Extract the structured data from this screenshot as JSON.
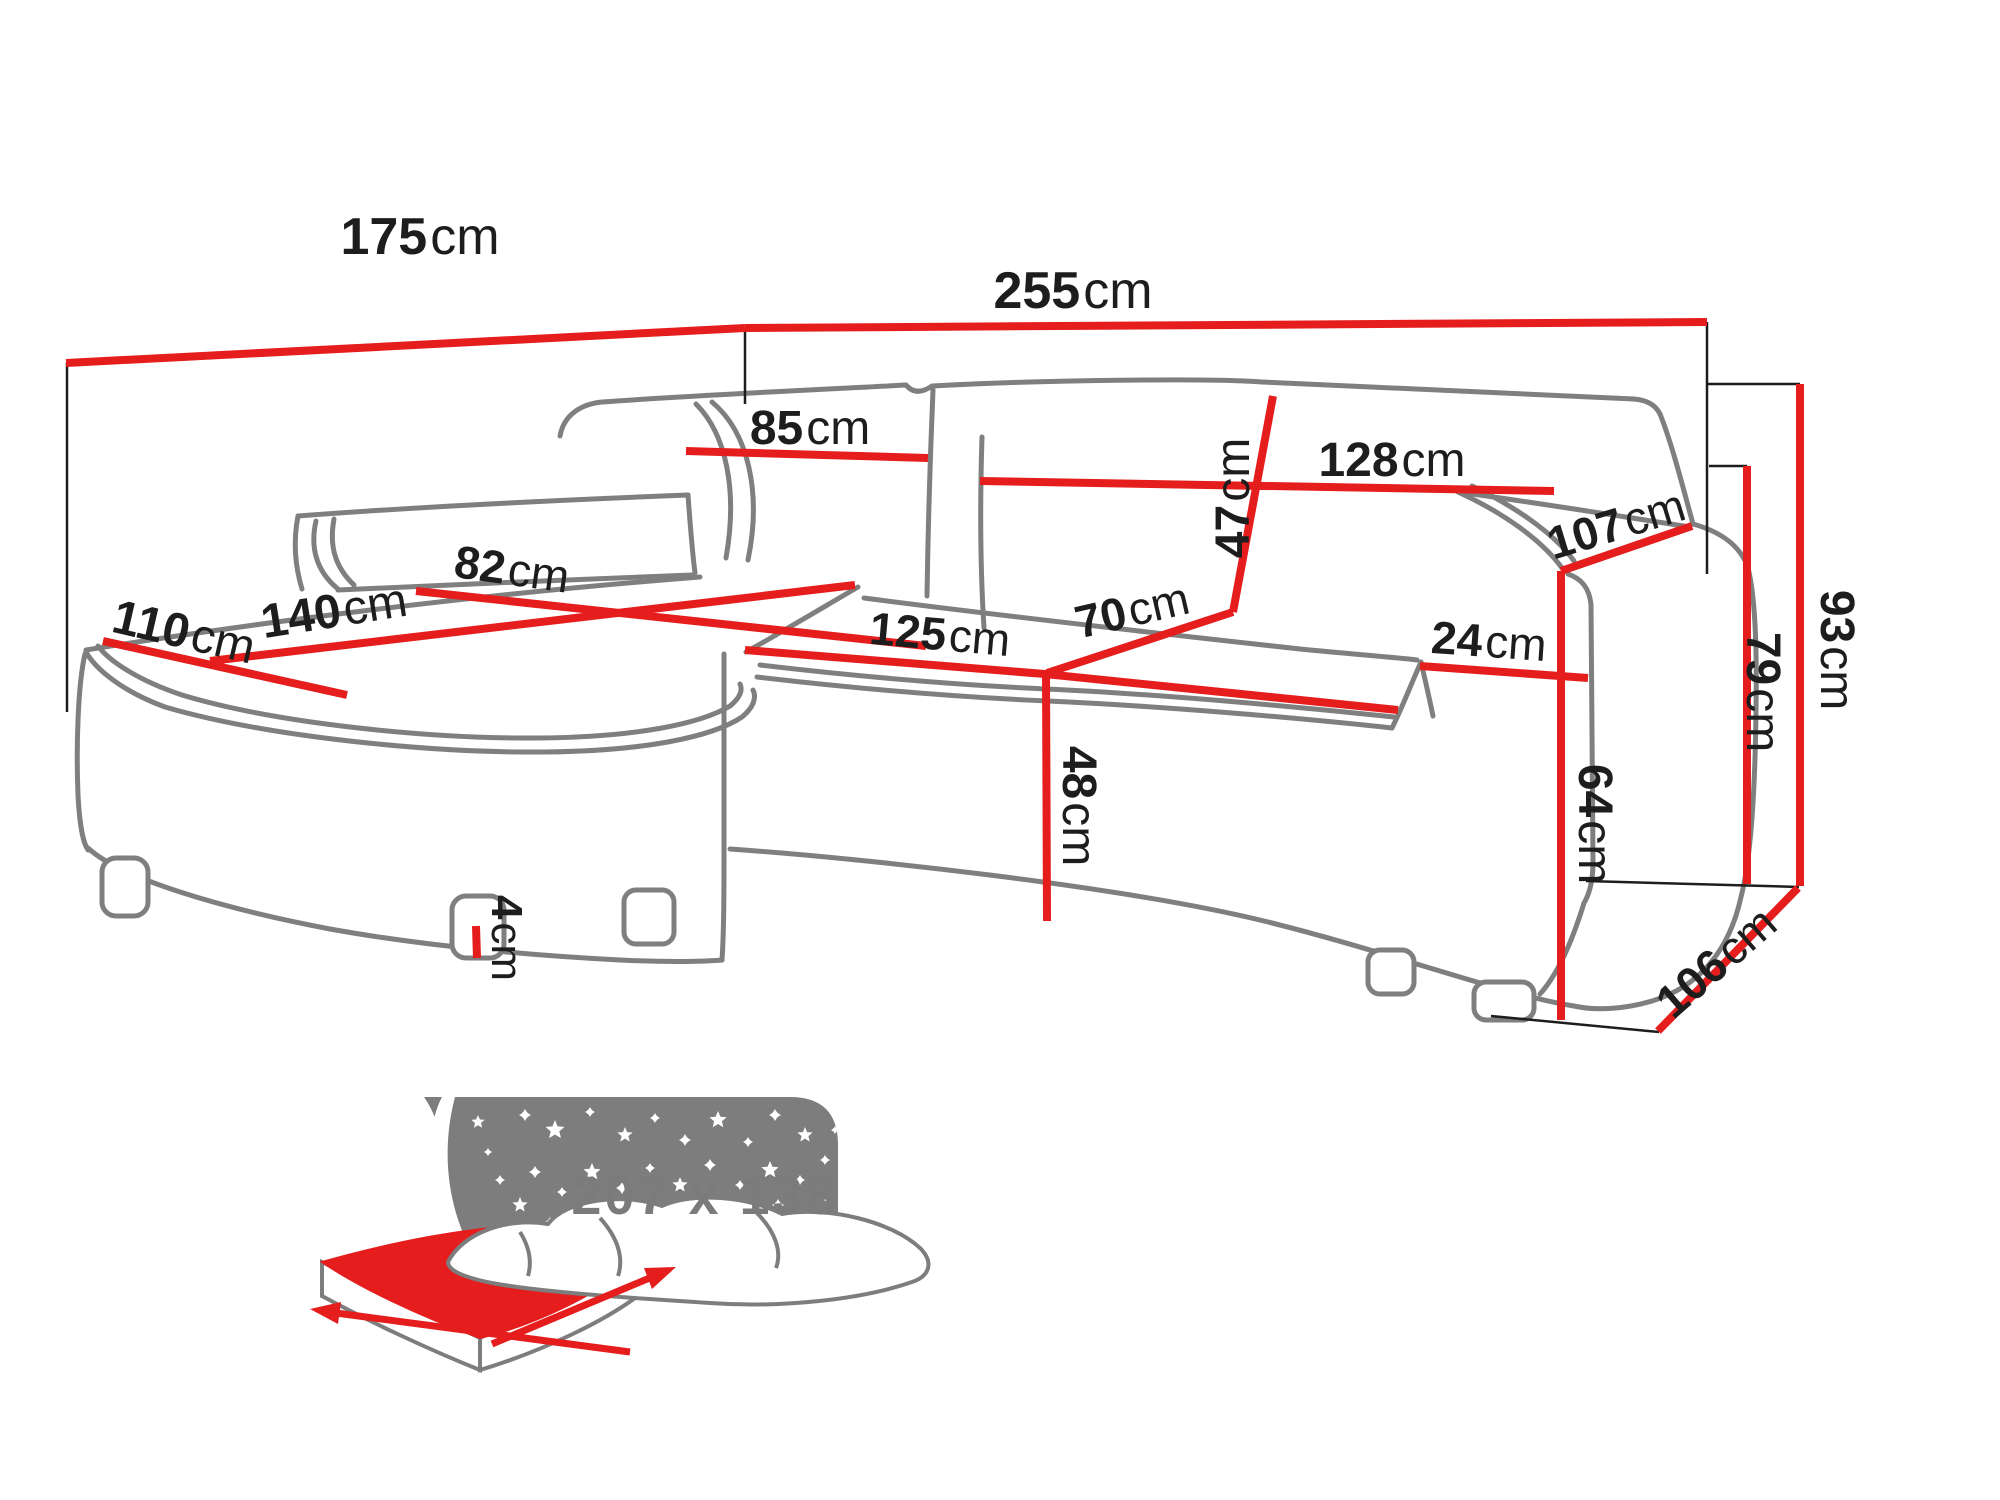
{
  "diagram": {
    "unit": "cm",
    "labels": {
      "d175": {
        "num": "175",
        "unit": "cm",
        "value": 175
      },
      "d255": {
        "num": "255",
        "unit": "cm",
        "value": 255
      },
      "d85": {
        "num": "85",
        "unit": "cm",
        "value": 85
      },
      "d128": {
        "num": "128",
        "unit": "cm",
        "value": 128
      },
      "d47": {
        "num": "47",
        "unit": "cm",
        "value": 47
      },
      "d107": {
        "num": "107",
        "unit": "cm",
        "value": 107
      },
      "d110": {
        "num": "110",
        "unit": "cm",
        "value": 110
      },
      "d140": {
        "num": "140",
        "unit": "cm",
        "value": 140
      },
      "d82": {
        "num": "82",
        "unit": "cm",
        "value": 82
      },
      "d125": {
        "num": "125",
        "unit": "cm",
        "value": 125
      },
      "d70": {
        "num": "70",
        "unit": "cm",
        "value": 70
      },
      "d24": {
        "num": "24",
        "unit": "cm",
        "value": 24
      },
      "d48": {
        "num": "48",
        "unit": "cm",
        "value": 48
      },
      "d64": {
        "num": "64",
        "unit": "cm",
        "value": 64
      },
      "d93": {
        "num": "93",
        "unit": "cm",
        "value": 93
      },
      "d79": {
        "num": "79",
        "unit": "cm",
        "value": 79
      },
      "d106": {
        "num": "106",
        "unit": "cm",
        "value": 106
      },
      "d4": {
        "num": "4",
        "unit": "cm",
        "value": 4
      }
    },
    "sleeping_area": {
      "label": "207 x 138",
      "width": 207,
      "depth": 138
    },
    "colors": {
      "dimension_red": "#e51d1d",
      "sofa_outline_gray": "#7f7f7f",
      "label_text": "#1d1d1d",
      "icon_gray": "#7d7d7d",
      "background": "#ffffff"
    }
  }
}
